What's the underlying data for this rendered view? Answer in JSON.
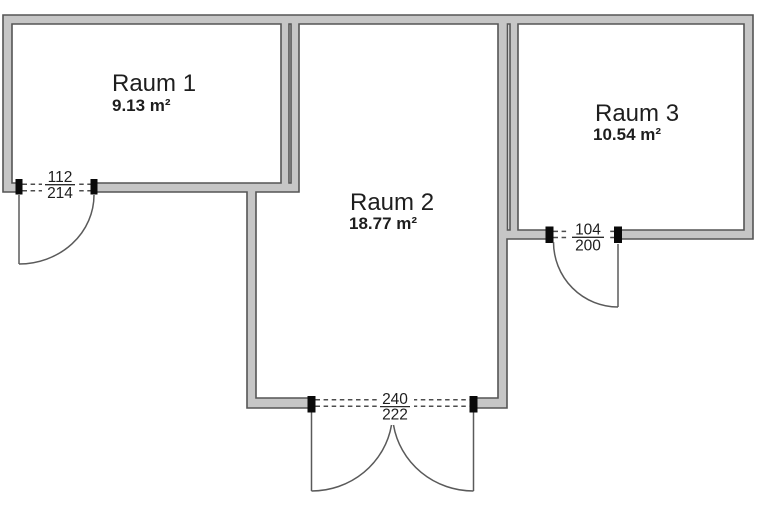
{
  "plan": {
    "rooms": [
      {
        "name": "Raum 1",
        "area": "9.13 m²"
      },
      {
        "name": "Raum 2",
        "area": "18.77 m²"
      },
      {
        "name": "Raum 3",
        "area": "10.54 m²"
      }
    ],
    "doors": [
      {
        "location": "raum-1-bottom-wall",
        "width_cm": "112",
        "height_cm": "214"
      },
      {
        "location": "raum-2-bottom-wall",
        "width_cm": "240",
        "height_cm": "222"
      },
      {
        "location": "raum-3-bottom-wall",
        "width_cm": "104",
        "height_cm": "200"
      }
    ],
    "colors": {
      "background": "#ffffff",
      "wall_fill": "#c6c6c6",
      "wall_edge": "#555555",
      "jamb": "#0a0a0a",
      "text": "#1e1e1e"
    }
  }
}
